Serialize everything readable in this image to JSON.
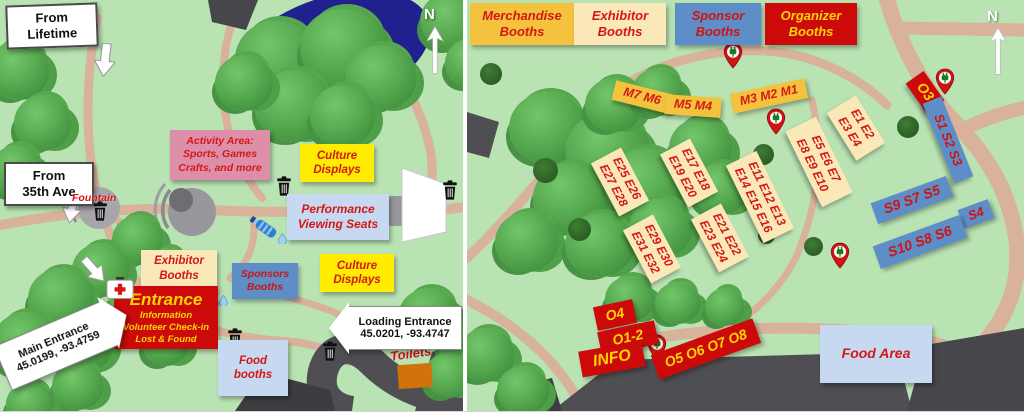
{
  "title": "Event park map — venue overview and booth placement",
  "colors": {
    "grass": "#b9e3b3",
    "path_tan": "#d9b29b",
    "pond_blue": "#20208f",
    "road_dark": "#4e4e53",
    "box_yellow": "#ffec00",
    "box_pink": "#dd8fa9",
    "box_light_blue": "#c7d9f0",
    "box_cream": "#fbe8b8",
    "box_gold": "#f4c33e",
    "box_blue": "#5d8ec7",
    "box_red": "#cc0a0a",
    "text_red": "#d41717",
    "text_yellow": "#ffd400",
    "toilet_orange": "#d2720a"
  },
  "icons": {
    "trash": "black trash can",
    "water_bottle": "blue water bottle with droplet",
    "power_pin": "red map pin with green plug",
    "first_aid": "white kit with red cross",
    "north_arrow": "white arrow pointing up",
    "direction_arrow": "white block arrow"
  },
  "left": {
    "from_lifetime": [
      "From",
      "Lifetime"
    ],
    "from_35th": [
      "From",
      "35th Ave"
    ],
    "activity_area": [
      "Activity Area:",
      "Sports, Games",
      "Crafts, and more"
    ],
    "culture_top": [
      "Culture",
      "Displays"
    ],
    "culture_bottom": [
      "Culture",
      "Displays"
    ],
    "performance": [
      "Performance",
      "Viewing Seats"
    ],
    "fountain": "Fountain",
    "exhibitor": [
      "Exhibitor",
      "Booths"
    ],
    "sponsors": [
      "Sponsors",
      "Booths"
    ],
    "entrance_title": "Entrance",
    "entrance_lines": [
      "Information",
      "Volunteer Check-in",
      "Lost & Found"
    ],
    "food_booths": [
      "Food",
      "booths"
    ],
    "toilets": "Toilets",
    "main_entrance": [
      "Main Entrance",
      "45.0199, -93.4759"
    ],
    "loading_entrance": [
      "Loading Entrance",
      "45.0201, -93.4747"
    ],
    "north": "N"
  },
  "right": {
    "legend": [
      {
        "lines": [
          "Merchandise",
          "Booths"
        ]
      },
      {
        "lines": [
          "Exhibitor",
          "Booths"
        ]
      },
      {
        "lines": [
          "Sponsor",
          "Booths"
        ]
      },
      {
        "lines": [
          "Organizer",
          "Booths"
        ]
      }
    ],
    "m_groups": [
      "M7 M6",
      "M5 M4",
      "M3 M2 M1"
    ],
    "e_groups": [
      {
        "l1": "E25 E26",
        "l2": "E27 E28"
      },
      {
        "l1": "E17 E18",
        "l2": "E19 E20"
      },
      {
        "l1": "E11 E12 E13",
        "l2": "E14 E15 E16"
      },
      {
        "l1": "E29 E30",
        "l2": "E31 E32"
      },
      {
        "l1": "E21 E22",
        "l2": "E23 E24"
      },
      {
        "l1": "E1 E2",
        "l2": "E3 E4"
      },
      {
        "l1": "E5 E6 E7",
        "l2": "E8 E9 E10"
      }
    ],
    "s_groups": [
      "S1 S2 S3",
      "S9 S7 S5",
      "S4",
      "S10 S8 S6"
    ],
    "o_groups": [
      "O3",
      "O4",
      "O1-2",
      "INFO",
      "O5 O6 O7 O8"
    ],
    "food_area": "Food Area",
    "north": "N"
  }
}
